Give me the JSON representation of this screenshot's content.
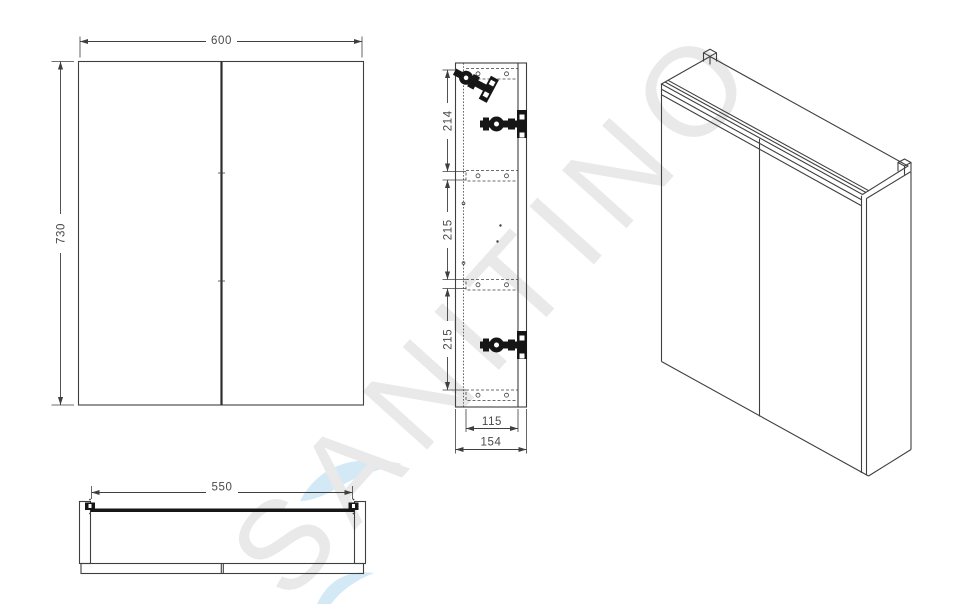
{
  "watermark": {
    "text": "SANITINO"
  },
  "colors": {
    "line": "#3f3f3f",
    "ink": "#161616",
    "dim_text": "#4a4a4a",
    "watermark_gray": "#e9e9e9",
    "watermark_blue": "#d3e9f6",
    "background": "#ffffff"
  },
  "front_view": {
    "label": "front-view",
    "width": "600",
    "height": "730"
  },
  "side_view": {
    "label": "side-view",
    "segment_top": "214",
    "segment_middle": "215",
    "segment_bottom": "215",
    "inner_width": "115",
    "depth": "154"
  },
  "bottom_view": {
    "label": "bottom-view",
    "width": "550"
  },
  "iso_view": {
    "label": "isometric-view"
  }
}
